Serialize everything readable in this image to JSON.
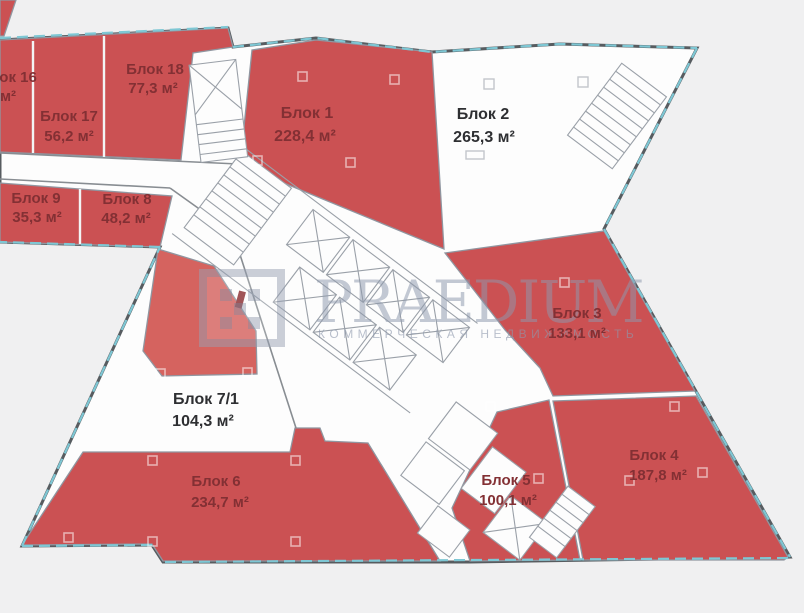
{
  "app": {
    "type": "floorplan-viewer",
    "units": "м²"
  },
  "watermark": {
    "brand": "PRAEDIUM",
    "subtitle": "КОММЕРЧЕСКАЯ НЕДВИЖИМОСТЬ",
    "color": "#8e99ad"
  },
  "palette": {
    "block_red": "#cb5153",
    "block_red_light": "#d5635f",
    "label_on_red": "#833034",
    "label_on_white": "#2e2f32",
    "wall": "#575c60",
    "window_glass": "#7ec7d4",
    "background": "#f0f0f1",
    "door_marker": "#8c3034"
  },
  "blocks": [
    {
      "id": "16",
      "label": "Блок 16",
      "area": "м²",
      "fill": "red",
      "note_clipped": true
    },
    {
      "id": "17",
      "label": "Блок 17",
      "area": "56,2 м²",
      "fill": "red"
    },
    {
      "id": "18",
      "label": "Блок 18",
      "area": "77,3 м²",
      "fill": "red"
    },
    {
      "id": "1",
      "label": "Блок 1",
      "area": "228,4 м²",
      "fill": "red"
    },
    {
      "id": "2",
      "label": "Блок 2",
      "area": "265,3 м²",
      "fill": "white"
    },
    {
      "id": "9",
      "label": "Блок 9",
      "area": "35,3 м²",
      "fill": "red"
    },
    {
      "id": "8",
      "label": "Блок 8",
      "area": "48,2 м²",
      "fill": "red"
    },
    {
      "id": "3",
      "label": "Блок 3",
      "area": "133,1 м²",
      "fill": "red"
    },
    {
      "id": "4",
      "label": "Блок 4",
      "area": "187,8 м²",
      "fill": "red"
    },
    {
      "id": "5",
      "label": "Блок 5",
      "area": "100,1 м²",
      "fill": "red"
    },
    {
      "id": "6",
      "label": "Блок 6",
      "area": "234,7 м²",
      "fill": "red"
    },
    {
      "id": "7/1",
      "label": "Блок 7/1",
      "area": "104,3 м²",
      "fill": "white"
    }
  ]
}
